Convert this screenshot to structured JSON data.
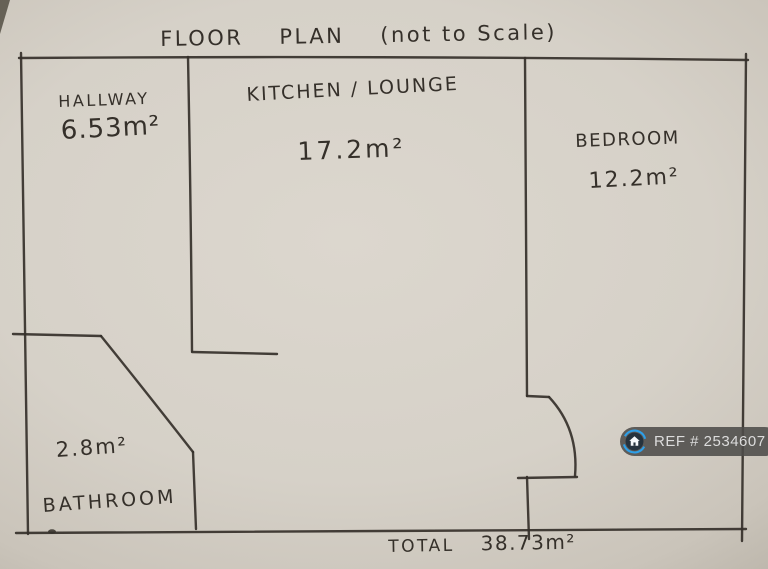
{
  "title": {
    "word1": "FLOOR",
    "word2": "PLAN",
    "word3": "(not to Scale)"
  },
  "rooms": {
    "hallway": {
      "name": "HALLWAY",
      "area": "6.53m²"
    },
    "kitchen_lounge": {
      "name": "KITCHEN / LOUNGE",
      "area": "17.2m²"
    },
    "bedroom": {
      "name": "BEDROOM",
      "area": "12.2m²"
    },
    "bathroom": {
      "name": "BATHROOM",
      "area": "2.8m²"
    }
  },
  "total": {
    "label": "TOTAL",
    "value": "38.73m²"
  },
  "ref_badge": {
    "text": "REF # 2534607",
    "icon": "house-icon",
    "pill_color": "#4d4c4a",
    "ring_color": "#2e9fe8",
    "icon_bg_color": "#26333e",
    "house_color": "#f5f8fa",
    "text_color": "#dcdcdc"
  },
  "colors": {
    "ink": "#35302a",
    "paper_center": "#dcd7ce",
    "paper_edge": "#aba598"
  }
}
